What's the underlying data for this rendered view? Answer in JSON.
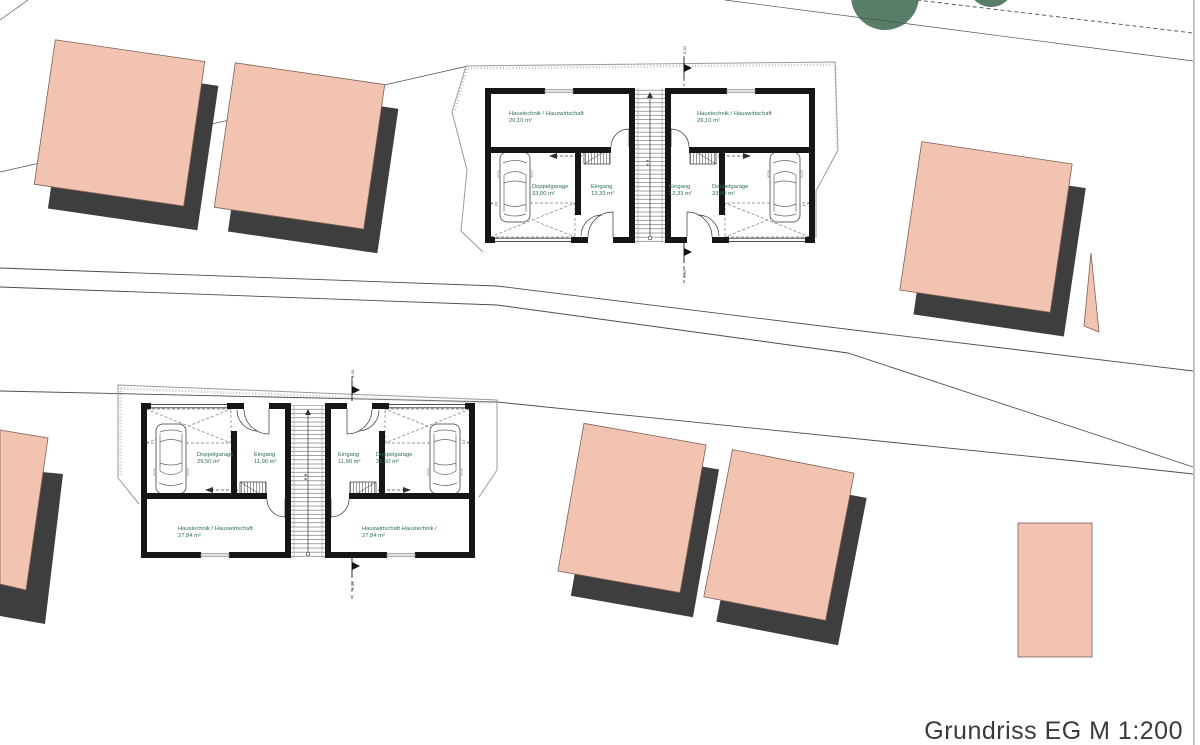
{
  "title": {
    "text": "Grundriss EG M 1:200"
  },
  "colors": {
    "neighbor_building": "#f2c3b1",
    "building_shadow": "#3e3e3e",
    "tree": "#597e67",
    "wall": "#161616",
    "room_label": "#2d6b5e"
  },
  "plans": {
    "top": {
      "section_label": "S-02",
      "units": {
        "left": {
          "utility": "Haustechnik / Hauswirtschaft",
          "utility_area": "26,10 m²",
          "garage": "Doppelgarage",
          "garage_area": "33,00 m²",
          "entry": "Eingang",
          "entry_area": "12,33 m²"
        },
        "right": {
          "utility": "Haustechnik / Hauswirtschaft",
          "utility_area": "26,10 m²",
          "garage": "Doppelgarage",
          "garage_area": "33,00 m²",
          "entry": "Eingang",
          "entry_area": "12,33 m²"
        }
      }
    },
    "bottom": {
      "section_label": "S-03",
      "units": {
        "left": {
          "garage": "Doppelgarage",
          "garage_area": "29,50 m²",
          "entry": "Eingang",
          "entry_area": "11,90 m²",
          "utility": "Haustechnik / Hauswirtschaft",
          "utility_area": "27,84 m²"
        },
        "right": {
          "garage": "Doppelgarage",
          "garage_area": "29,50 m²",
          "entry": "Eingang",
          "entry_area": "11,90 m²",
          "utility": "Hauswirtschaft Haustechnik /",
          "utility_area": "27,84 m²"
        }
      }
    }
  }
}
